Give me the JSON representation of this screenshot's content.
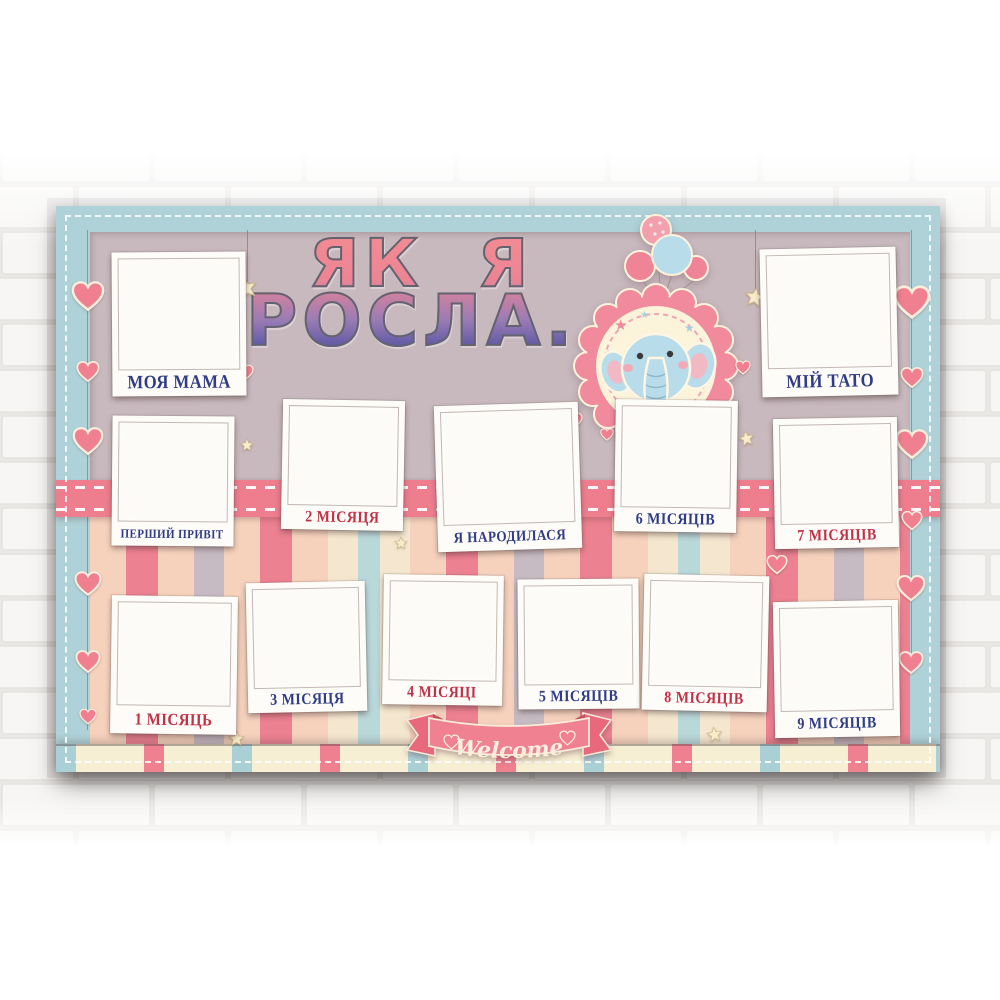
{
  "poster": {
    "title": {
      "line1": "ЯК Я",
      "line2": "РОСЛА..."
    },
    "frames": [
      {
        "id": "mama",
        "label": "МОЯ МАМА",
        "color": "navy"
      },
      {
        "id": "tato",
        "label": "МІЙ ТАТО",
        "color": "navy"
      },
      {
        "id": "first-hello",
        "label": "ПЕРШИЙ ПРИВІТ",
        "color": "navy"
      },
      {
        "id": "month-2",
        "label": "2 МІСЯЦЯ",
        "color": "red"
      },
      {
        "id": "born",
        "label": "Я НАРОДИЛАСЯ",
        "color": "navy"
      },
      {
        "id": "month-6",
        "label": "6 МІСЯЦІВ",
        "color": "navy"
      },
      {
        "id": "month-7",
        "label": "7 МІСЯЦІВ",
        "color": "red"
      },
      {
        "id": "month-1",
        "label": "1 МІСЯЦЬ",
        "color": "red"
      },
      {
        "id": "month-3",
        "label": "3 МІСЯЦЯ",
        "color": "navy"
      },
      {
        "id": "month-4",
        "label": "4 МІСЯЦІ",
        "color": "red"
      },
      {
        "id": "month-5",
        "label": "5 МІСЯЦІВ",
        "color": "navy"
      },
      {
        "id": "month-8",
        "label": "8 МІСЯЦІВ",
        "color": "red"
      },
      {
        "id": "month-9",
        "label": "9 МІСЯЦІВ",
        "color": "navy"
      }
    ],
    "banner": {
      "label": "Welcome"
    },
    "colors": {
      "border_blue": "#aed2d8",
      "background_mauve": "#c8b9be",
      "ribbon_pink": "#ee7e8e",
      "heart_pink": "#f0808f",
      "label_navy": "#303c86",
      "label_red": "#c13247",
      "cream": "#f6efd3",
      "title_gradient_top": "#f28a93",
      "title_gradient_bottom": "#5b57a5",
      "stripe_peach": "#f6d2bd",
      "stripe_red": "#ec8191",
      "stripe_grey": "#c7bbc3",
      "stripe_blue": "#b9d8da"
    }
  }
}
